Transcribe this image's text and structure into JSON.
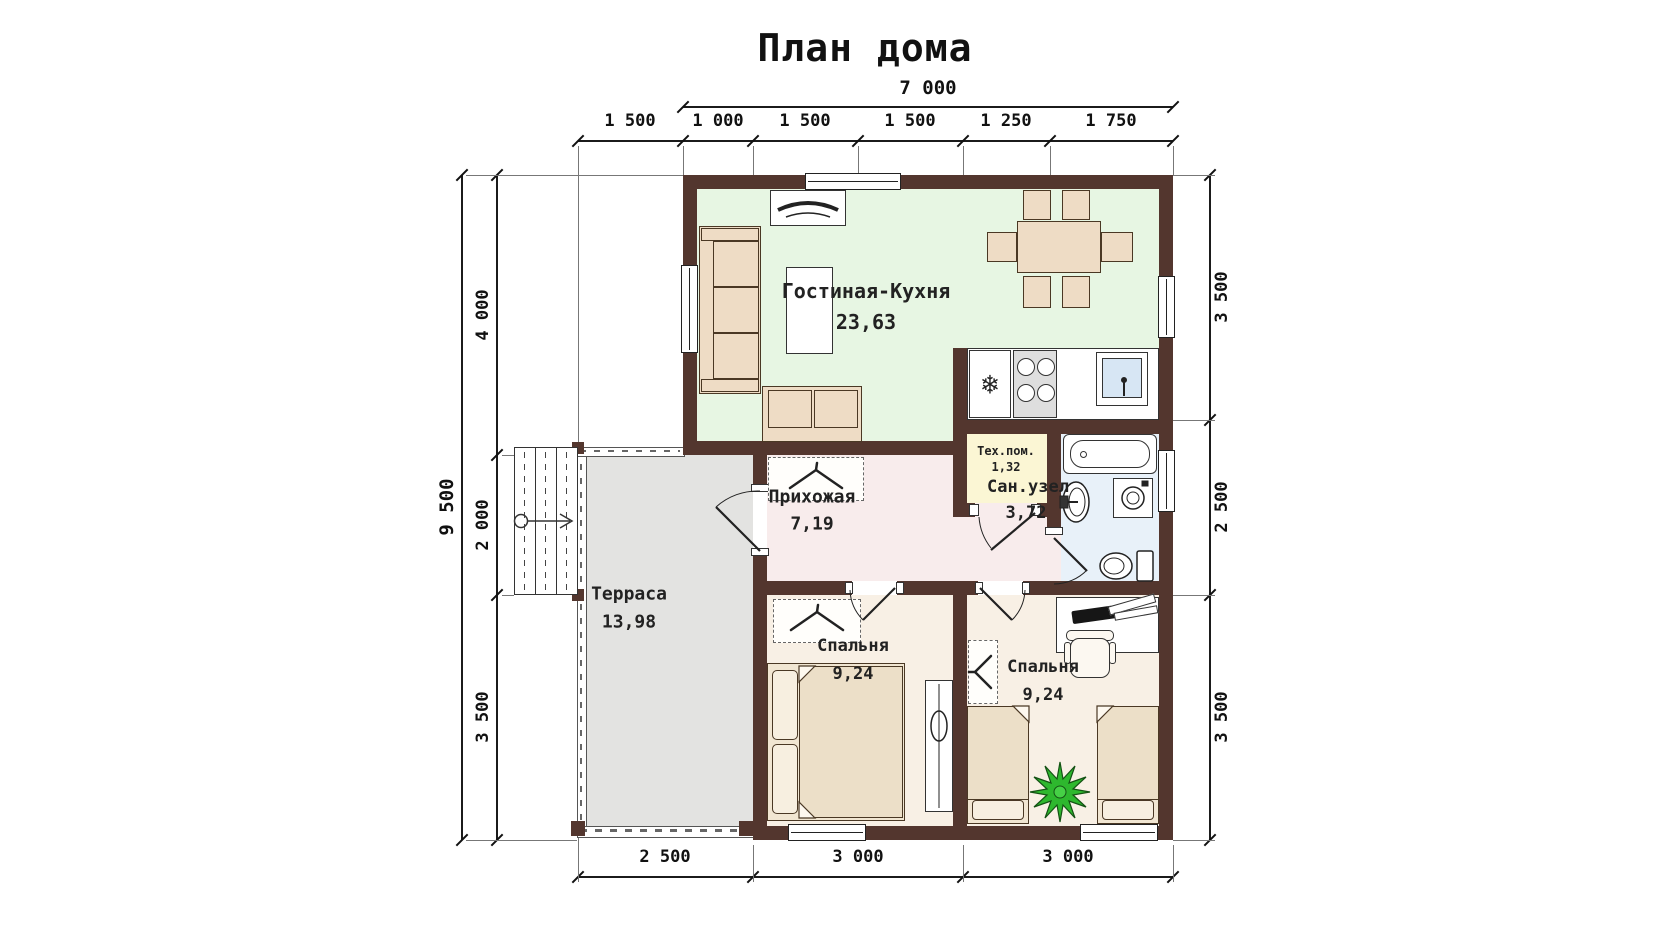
{
  "title": "План дома",
  "rooms": {
    "living": {
      "name": "Гостиная-Кухня",
      "area": "23,63"
    },
    "hallway": {
      "name": "Прихожая",
      "area": "7,19"
    },
    "tech": {
      "name": "Тех.пом.",
      "area": "1,32"
    },
    "bath": {
      "name": "Сан.узел",
      "area": "3,72"
    },
    "terrace": {
      "name": "Терраса",
      "area": "13,98"
    },
    "bedroom1": {
      "name": "Спальня",
      "area": "9,24"
    },
    "bedroom2": {
      "name": "Спальня",
      "area": "9,24"
    }
  },
  "dimensions": {
    "top_total": "7 000",
    "top": [
      "1 500",
      "1 000",
      "1 500",
      "1 500",
      "1 250",
      "1 750"
    ],
    "left_total": "9 500",
    "left": [
      "4 000",
      "2 000",
      "3 500"
    ],
    "right": [
      "3 500",
      "2 500",
      "3 500"
    ],
    "bottom": [
      "2 500",
      "3 000",
      "3 000"
    ]
  },
  "icons": {
    "fridge_snowflake": "❄"
  },
  "colors": {
    "wall": "#53362e",
    "living": "#e7f6e3",
    "hallway": "#f8ecec",
    "tech": "#fbf6d4",
    "bath": "#e8f1f9",
    "bedroom": "#f8f0e5",
    "terrace": "#e3e3e1",
    "furniture": "#eedcc5",
    "plant": "#2eb82e"
  }
}
